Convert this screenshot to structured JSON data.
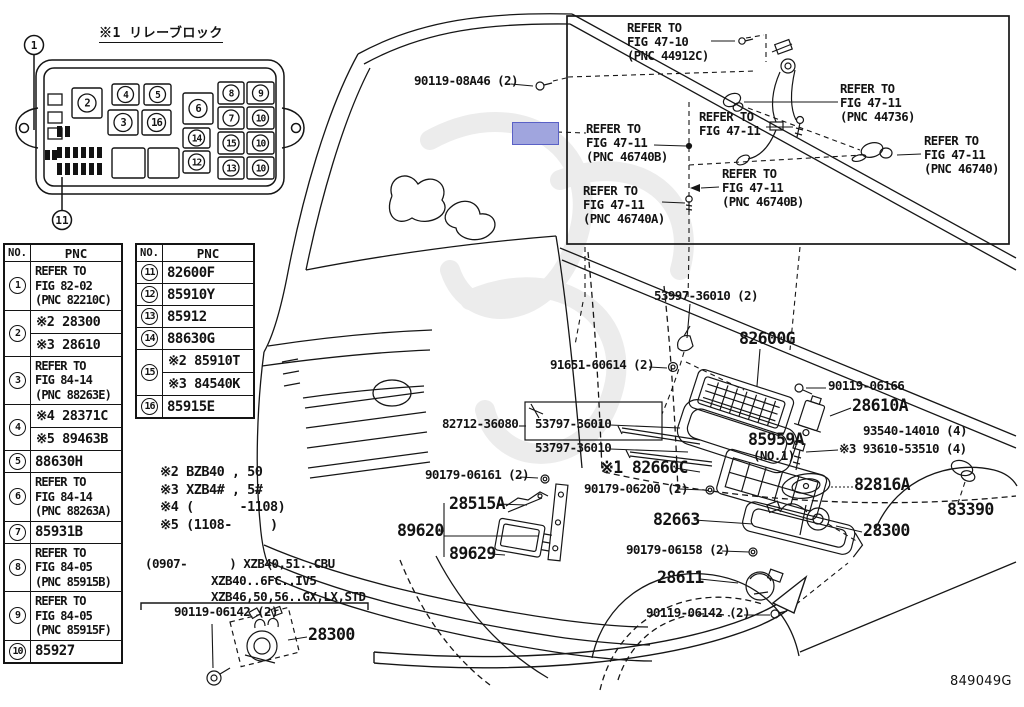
{
  "doc": {
    "code": "849049G"
  },
  "relay_block": {
    "title": "※1 リレーブロック",
    "top_callout": "1",
    "bottom_callout": "11",
    "slots": [
      {
        "n": "2",
        "x": 72,
        "y": 88,
        "w": 30,
        "h": 30
      },
      {
        "n": "4",
        "x": 112,
        "y": 84,
        "w": 27,
        "h": 21
      },
      {
        "n": "5",
        "x": 144,
        "y": 84,
        "w": 27,
        "h": 21
      },
      {
        "n": "3",
        "x": 108,
        "y": 110,
        "w": 30,
        "h": 25
      },
      {
        "n": "16",
        "x": 142,
        "y": 110,
        "w": 29,
        "h": 25
      },
      {
        "n": "6",
        "x": 183,
        "y": 93,
        "w": 30,
        "h": 31
      },
      {
        "n": "8",
        "x": 218,
        "y": 82,
        "w": 26,
        "h": 22
      },
      {
        "n": "9",
        "x": 247,
        "y": 82,
        "w": 27,
        "h": 22
      },
      {
        "n": "7",
        "x": 218,
        "y": 107,
        "w": 26,
        "h": 22
      },
      {
        "n": "10",
        "x": 247,
        "y": 107,
        "w": 27,
        "h": 22
      },
      {
        "n": "14",
        "x": 183,
        "y": 128,
        "w": 27,
        "h": 20
      },
      {
        "n": "15",
        "x": 218,
        "y": 132,
        "w": 26,
        "h": 22
      },
      {
        "n": "10",
        "x": 247,
        "y": 132,
        "w": 27,
        "h": 22
      },
      {
        "n": "12",
        "x": 183,
        "y": 151,
        "w": 27,
        "h": 22
      },
      {
        "n": "13",
        "x": 218,
        "y": 157,
        "w": 26,
        "h": 22
      },
      {
        "n": "10",
        "x": 247,
        "y": 157,
        "w": 27,
        "h": 22
      },
      {
        "n": "",
        "x": 112,
        "y": 148,
        "w": 33,
        "h": 30
      },
      {
        "n": "",
        "x": 148,
        "y": 148,
        "w": 31,
        "h": 30
      }
    ]
  },
  "tables": [
    {
      "headers": [
        "NO.",
        "PNC"
      ],
      "rows": [
        {
          "no": "1",
          "lines": [
            "REFER TO",
            "FIG 82-02",
            "(PNC 82210C)"
          ]
        },
        {
          "no": "2",
          "subrows": [
            "※2 28300",
            "※3 28610"
          ]
        },
        {
          "no": "3",
          "lines": [
            "REFER TO",
            "FIG 84-14",
            "(PNC 88263E)"
          ]
        },
        {
          "no": "4",
          "subrows": [
            "※4 28371C",
            "※5 89463B"
          ]
        },
        {
          "no": "5",
          "lines": [
            "88630H"
          ]
        },
        {
          "no": "6",
          "lines": [
            "REFER TO",
            "FIG 84-14",
            "(PNC 88263A)"
          ]
        },
        {
          "no": "7",
          "lines": [
            "85931B"
          ]
        },
        {
          "no": "8",
          "lines": [
            "REFER TO",
            "FIG 84-05",
            "(PNC 85915B)"
          ]
        },
        {
          "no": "9",
          "lines": [
            "REFER TO",
            "FIG 84-05",
            "(PNC 85915F)"
          ]
        },
        {
          "no": "10",
          "lines": [
            "85927"
          ]
        }
      ]
    },
    {
      "headers": [
        "NO.",
        "PNC"
      ],
      "rows": [
        {
          "no": "11",
          "lines": [
            "82600F"
          ]
        },
        {
          "no": "12",
          "lines": [
            "85910Y"
          ]
        },
        {
          "no": "13",
          "lines": [
            "85912"
          ]
        },
        {
          "no": "14",
          "lines": [
            "88630G"
          ]
        },
        {
          "no": "15",
          "subrows": [
            "※2 85910T",
            "※3 84540K"
          ]
        },
        {
          "no": "16",
          "lines": [
            "85915E"
          ]
        }
      ]
    }
  ],
  "notes": {
    "variants": [
      "※2 BZB40 , 50",
      "※3 XZB4# , 5#",
      "※4 (      -1108)",
      "※5 (1108-     )"
    ],
    "applicability": [
      "(0907-      ) XZB40,51..CBU",
      "XZB40..6FC..IV5",
      "XZB46,50,56..GX,LX,STD"
    ]
  },
  "callouts": [
    {
      "text": "90119-08A46 (2)",
      "x": 414,
      "y": 75,
      "s": "sm"
    },
    {
      "text": "53997-36010 (2)",
      "x": 654,
      "y": 290,
      "s": "sm"
    },
    {
      "text": "82600G",
      "x": 739,
      "y": 331,
      "s": "lg"
    },
    {
      "text": "91651-60614 (2)",
      "x": 550,
      "y": 359,
      "s": "sm"
    },
    {
      "text": "90119-06166",
      "x": 828,
      "y": 380,
      "s": "sm"
    },
    {
      "text": "28610A",
      "x": 852,
      "y": 398,
      "s": "lg"
    },
    {
      "text": "93540-14010 (4)",
      "x": 863,
      "y": 425,
      "s": "sm"
    },
    {
      "text": "※3 93610-53510 (4)",
      "x": 839,
      "y": 443,
      "s": "sm"
    },
    {
      "text": "85959A",
      "x": 748,
      "y": 432,
      "s": "lg"
    },
    {
      "text": "(NO.1)",
      "x": 753,
      "y": 450,
      "s": "sm"
    },
    {
      "text": "※1 82660C",
      "x": 600,
      "y": 460,
      "s": "lg"
    },
    {
      "text": "90179-06200 (2)",
      "x": 584,
      "y": 483,
      "s": "sm"
    },
    {
      "text": "82663",
      "x": 653,
      "y": 512,
      "s": "lg"
    },
    {
      "text": "90179-06158 (2)",
      "x": 626,
      "y": 544,
      "s": "sm"
    },
    {
      "text": "28611",
      "x": 657,
      "y": 570,
      "s": "lg"
    },
    {
      "text": "90119-06142 (2)",
      "x": 646,
      "y": 607,
      "s": "sm"
    },
    {
      "text": "28300",
      "x": 863,
      "y": 523,
      "s": "lg"
    },
    {
      "text": "82816A",
      "x": 854,
      "y": 477,
      "s": "lg"
    },
    {
      "text": "83390",
      "x": 947,
      "y": 502,
      "s": "lg"
    },
    {
      "text": "82712-36080",
      "x": 442,
      "y": 418,
      "s": "sm"
    },
    {
      "text": "53797-36010",
      "x": 535,
      "y": 418,
      "s": "sm"
    },
    {
      "text": "53797-36010",
      "x": 535,
      "y": 442,
      "s": "sm"
    },
    {
      "text": "90179-06161 (2)",
      "x": 425,
      "y": 469,
      "s": "sm"
    },
    {
      "text": "28515A",
      "x": 449,
      "y": 496,
      "s": "lg"
    },
    {
      "text": "89620",
      "x": 397,
      "y": 523,
      "s": "lg"
    },
    {
      "text": "89629",
      "x": 449,
      "y": 546,
      "s": "lg"
    },
    {
      "text": "90119-06142 (2)",
      "x": 174,
      "y": 606,
      "s": "sm"
    },
    {
      "text": "28300",
      "x": 308,
      "y": 627,
      "s": "lg"
    },
    {
      "text": "849049G",
      "x": 950,
      "y": 675,
      "s": "code"
    }
  ],
  "refer_labels": [
    {
      "lines": [
        "REFER TO",
        "FIG 47-10",
        "(PNC 44912C)"
      ],
      "x": 627,
      "y": 22
    },
    {
      "lines": [
        "REFER TO",
        "FIG 47-11",
        "(PNC 44736)"
      ],
      "x": 840,
      "y": 83
    },
    {
      "lines": [
        "REFER TO",
        "FIG 47-11"
      ],
      "x": 699,
      "y": 111
    },
    {
      "lines": [
        "REFER TO",
        "FIG 47-11",
        "(PNC 46740B)"
      ],
      "x": 586,
      "y": 123
    },
    {
      "lines": [
        "REFER TO",
        "FIG 47-11",
        "(PNC 46740)"
      ],
      "x": 924,
      "y": 135
    },
    {
      "lines": [
        "REFER TO",
        "FIG 47-11",
        "(PNC 46740B)"
      ],
      "x": 722,
      "y": 168
    },
    {
      "lines": [
        "REFER TO",
        "FIG 47-11",
        "(PNC 46740A)"
      ],
      "x": 583,
      "y": 185
    }
  ],
  "highlight": {
    "x": 512,
    "y": 122,
    "w": 45,
    "h": 21,
    "fill": "#a0a5de",
    "stroke": "#5a61c6"
  }
}
